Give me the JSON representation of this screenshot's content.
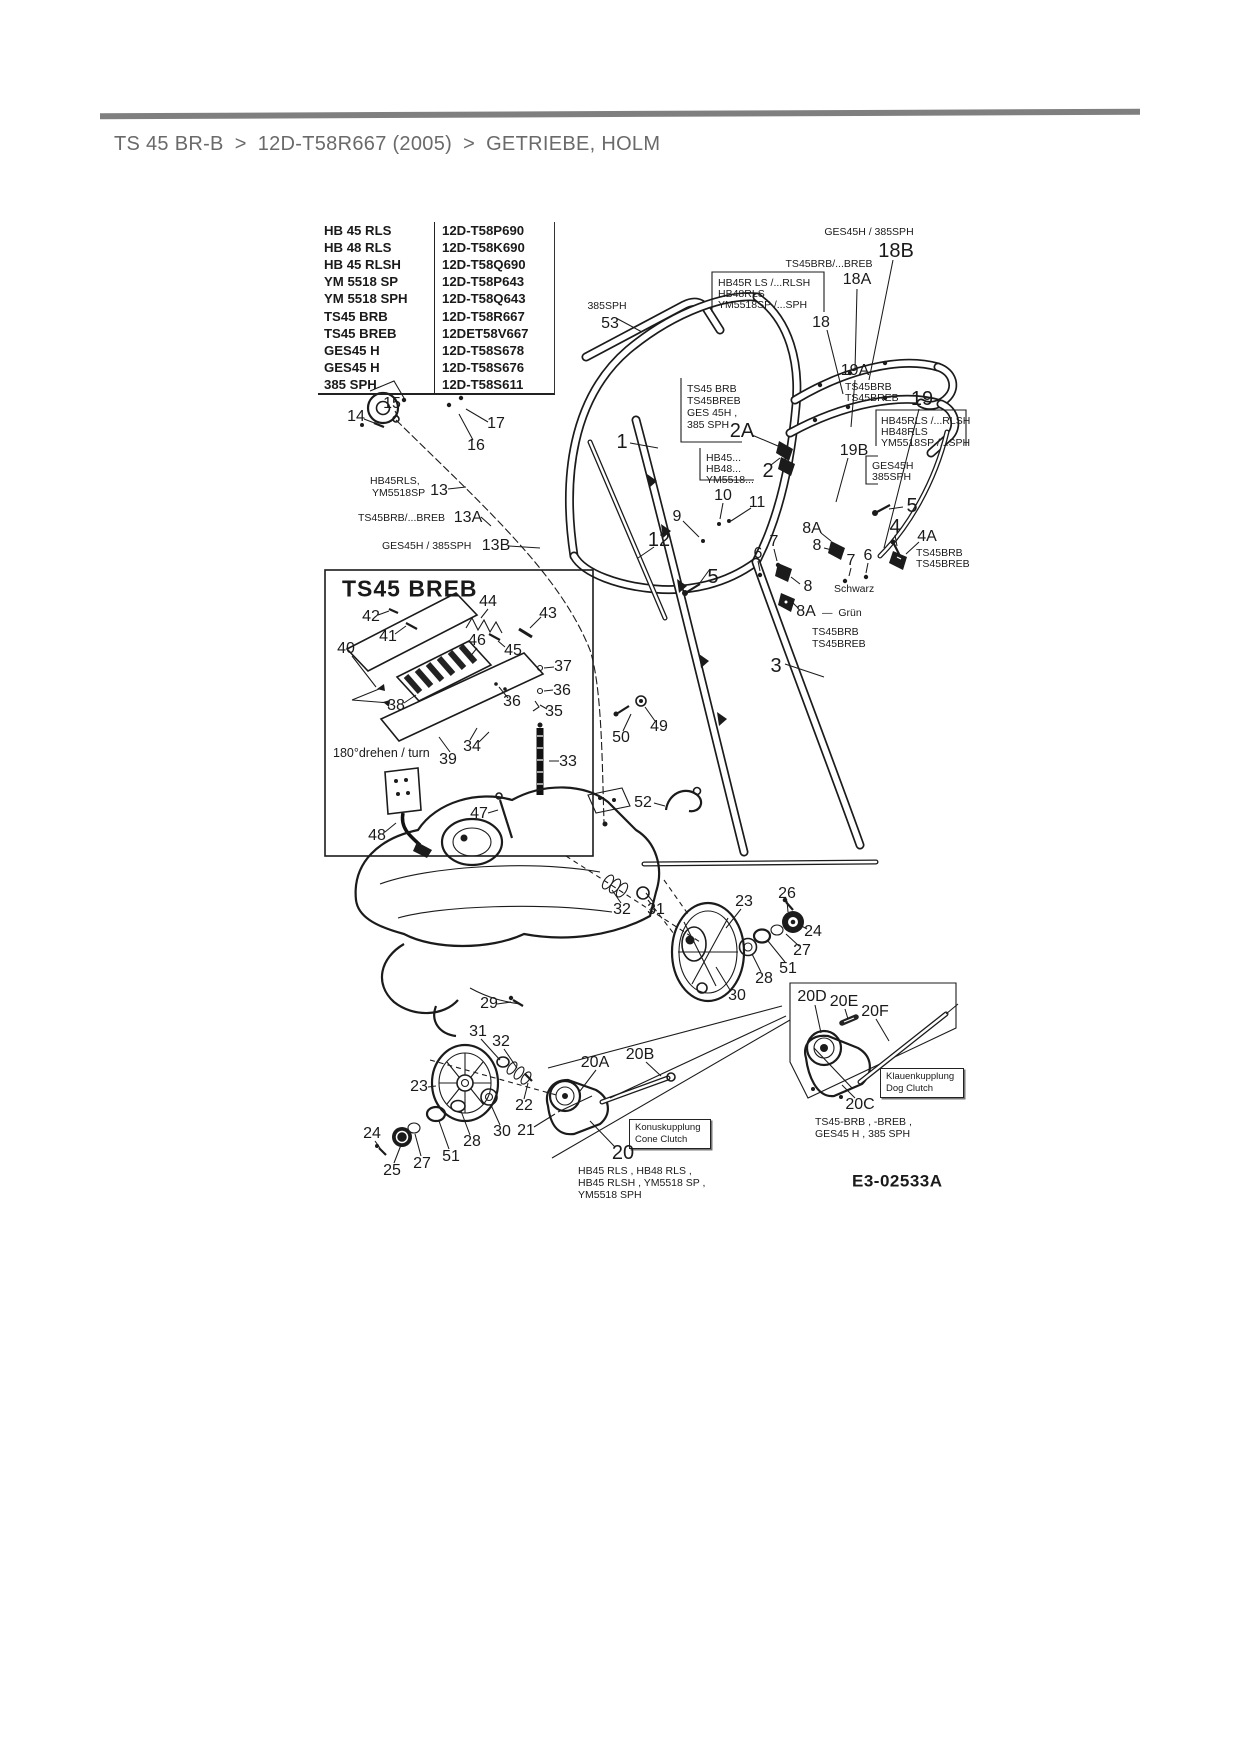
{
  "breadcrumb": {
    "separator": ">",
    "items": [
      "TS 45 BR-B",
      "12D-T58R667 (2005)",
      "GETRIEBE, HOLM"
    ]
  },
  "model_table": {
    "rows": [
      {
        "model": "HB 45 RLS",
        "artno": "12D-T58P690"
      },
      {
        "model": "HB 48 RLS",
        "artno": "12D-T58K690"
      },
      {
        "model": "HB 45 RLSH",
        "artno": "12D-T58Q690"
      },
      {
        "model": "YM 5518 SP",
        "artno": "12D-T58P643"
      },
      {
        "model": "YM 5518 SPH",
        "artno": "12D-T58Q643"
      },
      {
        "model": "TS45 BRB",
        "artno": "12D-T58R667"
      },
      {
        "model": "TS45 BREB",
        "artno": "12DET58V667"
      },
      {
        "model": "GES45 H",
        "artno": "12D-T58S678"
      },
      {
        "model": "GES45 H",
        "artno": "12D-T58S676"
      },
      {
        "model": "385 SPH",
        "artno": "12D-T58S611"
      }
    ]
  },
  "clutch": {
    "dog": [
      "Klauenkupplung",
      "Dog Clutch"
    ],
    "cone": [
      "Konuskupplung",
      "Cone Clutch"
    ]
  },
  "diagram_id": "E3-02533A",
  "ink_color": "#1b1b1b",
  "rule_color": "#7f7f7f",
  "labels": [
    {
      "t": "385SPH",
      "x": 607,
      "y": 306,
      "c": "xs"
    },
    {
      "t": "53",
      "x": 610,
      "y": 324,
      "c": "md"
    },
    {
      "t": "GES45H / 385SPH",
      "x": 869,
      "y": 232,
      "c": "xs"
    },
    {
      "t": "18B",
      "x": 896,
      "y": 251,
      "c": "lg"
    },
    {
      "t": "TS45BRB/...BREB",
      "x": 829,
      "y": 264,
      "c": "xs"
    },
    {
      "t": "18A",
      "x": 857,
      "y": 280,
      "c": "md"
    },
    {
      "t": "HB45R LS /...RLSH",
      "x": 718,
      "y": 283,
      "c": "xs",
      "a": "l"
    },
    {
      "t": "HB48RLS",
      "x": 718,
      "y": 294,
      "c": "xs",
      "a": "l"
    },
    {
      "t": "YM5518SP /...SPH",
      "x": 718,
      "y": 305,
      "c": "xs",
      "a": "l"
    },
    {
      "t": "18",
      "x": 821,
      "y": 323,
      "c": "md"
    },
    {
      "t": "19A",
      "x": 855,
      "y": 371,
      "c": "md"
    },
    {
      "t": "TS45BRB",
      "x": 845,
      "y": 387,
      "c": "xs",
      "a": "l"
    },
    {
      "t": "TS45BREB",
      "x": 845,
      "y": 398,
      "c": "xs",
      "a": "l"
    },
    {
      "t": "19",
      "x": 922,
      "y": 399,
      "c": "lg"
    },
    {
      "t": "HB45RLS /...RLSH",
      "x": 881,
      "y": 421,
      "c": "xs",
      "a": "l"
    },
    {
      "t": "HB48RLS",
      "x": 881,
      "y": 432,
      "c": "xs",
      "a": "l"
    },
    {
      "t": "YM5518SP /...SPH",
      "x": 881,
      "y": 443,
      "c": "xs",
      "a": "l"
    },
    {
      "t": "19B",
      "x": 854,
      "y": 451,
      "c": "md"
    },
    {
      "t": "GES45H",
      "x": 872,
      "y": 466,
      "c": "xs",
      "a": "l"
    },
    {
      "t": "385SPH",
      "x": 872,
      "y": 477,
      "c": "xs",
      "a": "l"
    },
    {
      "t": "TS45 BRB",
      "x": 687,
      "y": 389,
      "c": "xs",
      "a": "l"
    },
    {
      "t": "TS45BREB",
      "x": 687,
      "y": 401,
      "c": "xs",
      "a": "l"
    },
    {
      "t": "GES 45H ,",
      "x": 687,
      "y": 413,
      "c": "xs",
      "a": "l"
    },
    {
      "t": "385 SPH",
      "x": 687,
      "y": 425,
      "c": "xs",
      "a": "l"
    },
    {
      "t": "2A",
      "x": 742,
      "y": 431,
      "c": "lg"
    },
    {
      "t": "HB45...",
      "x": 706,
      "y": 458,
      "c": "xs",
      "a": "l"
    },
    {
      "t": "HB48...",
      "x": 706,
      "y": 469,
      "c": "xs",
      "a": "l"
    },
    {
      "t": "YM5518...",
      "x": 706,
      "y": 480,
      "c": "xs",
      "a": "l"
    },
    {
      "t": "2",
      "x": 768,
      "y": 471,
      "c": "lg"
    },
    {
      "t": "1",
      "x": 622,
      "y": 442,
      "c": "lg"
    },
    {
      "t": "10",
      "x": 723,
      "y": 496,
      "c": "md"
    },
    {
      "t": "11",
      "x": 757,
      "y": 503,
      "c": "md"
    },
    {
      "t": "9",
      "x": 677,
      "y": 517,
      "c": "md"
    },
    {
      "t": "12",
      "x": 659,
      "y": 540,
      "c": "lg"
    },
    {
      "t": "5",
      "x": 713,
      "y": 577,
      "c": "lg"
    },
    {
      "t": "5",
      "x": 912,
      "y": 506,
      "c": "lg"
    },
    {
      "t": "4",
      "x": 895,
      "y": 527,
      "c": "lg"
    },
    {
      "t": "4A",
      "x": 927,
      "y": 537,
      "c": "md"
    },
    {
      "t": "TS45BRB",
      "x": 916,
      "y": 553,
      "c": "xs",
      "a": "l"
    },
    {
      "t": "TS45BREB",
      "x": 916,
      "y": 564,
      "c": "xs",
      "a": "l"
    },
    {
      "t": "8A",
      "x": 812,
      "y": 529,
      "c": "md"
    },
    {
      "t": "8",
      "x": 817,
      "y": 546,
      "c": "md"
    },
    {
      "t": "7",
      "x": 774,
      "y": 542,
      "c": "md"
    },
    {
      "t": "7",
      "x": 851,
      "y": 561,
      "c": "md"
    },
    {
      "t": "6",
      "x": 758,
      "y": 554,
      "c": "md"
    },
    {
      "t": "6",
      "x": 868,
      "y": 556,
      "c": "md"
    },
    {
      "t": "8",
      "x": 808,
      "y": 587,
      "c": "md"
    },
    {
      "t": "Schwarz",
      "x": 834,
      "y": 589,
      "c": "xs",
      "a": "l"
    },
    {
      "t": "8A",
      "x": 806,
      "y": 612,
      "c": "md"
    },
    {
      "t": "—  Grün",
      "x": 822,
      "y": 613,
      "c": "xs",
      "a": "l"
    },
    {
      "t": "TS45BRB",
      "x": 812,
      "y": 632,
      "c": "xs",
      "a": "l"
    },
    {
      "t": "TS45BREB",
      "x": 812,
      "y": 644,
      "c": "xs",
      "a": "l"
    },
    {
      "t": "3",
      "x": 776,
      "y": 666,
      "c": "lg"
    },
    {
      "t": "14",
      "x": 356,
      "y": 417,
      "c": "md"
    },
    {
      "t": "15",
      "x": 392,
      "y": 404,
      "c": "md"
    },
    {
      "t": "17",
      "x": 496,
      "y": 424,
      "c": "md"
    },
    {
      "t": "16",
      "x": 476,
      "y": 446,
      "c": "md"
    },
    {
      "t": "HB45RLS,",
      "x": 370,
      "y": 481,
      "c": "xs",
      "a": "l"
    },
    {
      "t": "YM5518SP",
      "x": 372,
      "y": 493,
      "c": "xs",
      "a": "l"
    },
    {
      "t": "13",
      "x": 439,
      "y": 491,
      "c": "md"
    },
    {
      "t": "TS45BRB/...BREB",
      "x": 358,
      "y": 518,
      "c": "xs",
      "a": "l"
    },
    {
      "t": "13A",
      "x": 468,
      "y": 518,
      "c": "md"
    },
    {
      "t": "GES45H / 385SPH",
      "x": 382,
      "y": 546,
      "c": "xs",
      "a": "l"
    },
    {
      "t": "13B",
      "x": 496,
      "y": 546,
      "c": "md"
    },
    {
      "t": "49",
      "x": 659,
      "y": 727,
      "c": "md"
    },
    {
      "t": "50",
      "x": 621,
      "y": 738,
      "c": "md"
    },
    {
      "t": "52",
      "x": 643,
      "y": 803,
      "c": "md"
    },
    {
      "t": "TS45 BREB",
      "x": 342,
      "y": 589,
      "c": "title",
      "a": "l",
      "n": "inset-title"
    },
    {
      "t": "42",
      "x": 371,
      "y": 617,
      "c": "md"
    },
    {
      "t": "41",
      "x": 388,
      "y": 637,
      "c": "md"
    },
    {
      "t": "40",
      "x": 346,
      "y": 649,
      "c": "md"
    },
    {
      "t": "44",
      "x": 488,
      "y": 602,
      "c": "md"
    },
    {
      "t": "43",
      "x": 548,
      "y": 614,
      "c": "md"
    },
    {
      "t": "46",
      "x": 477,
      "y": 641,
      "c": "md"
    },
    {
      "t": "45",
      "x": 513,
      "y": 651,
      "c": "md"
    },
    {
      "t": "37",
      "x": 563,
      "y": 667,
      "c": "md"
    },
    {
      "t": "36",
      "x": 562,
      "y": 691,
      "c": "md"
    },
    {
      "t": "35",
      "x": 554,
      "y": 712,
      "c": "md"
    },
    {
      "t": "36",
      "x": 512,
      "y": 702,
      "c": "md"
    },
    {
      "t": "38",
      "x": 396,
      "y": 706,
      "c": "md"
    },
    {
      "t": "34",
      "x": 472,
      "y": 747,
      "c": "md"
    },
    {
      "t": "39",
      "x": 448,
      "y": 760,
      "c": "md"
    },
    {
      "t": "33",
      "x": 568,
      "y": 762,
      "c": "md"
    },
    {
      "t": "180°drehen / turn",
      "x": 333,
      "y": 753,
      "c": "sm",
      "a": "l",
      "n": "rotate-note"
    },
    {
      "t": "47",
      "x": 479,
      "y": 814,
      "c": "md"
    },
    {
      "t": "48",
      "x": 377,
      "y": 836,
      "c": "md"
    },
    {
      "t": "23",
      "x": 744,
      "y": 902,
      "c": "md"
    },
    {
      "t": "26",
      "x": 787,
      "y": 894,
      "c": "md"
    },
    {
      "t": "24",
      "x": 813,
      "y": 932,
      "c": "md"
    },
    {
      "t": "27",
      "x": 802,
      "y": 951,
      "c": "md"
    },
    {
      "t": "51",
      "x": 788,
      "y": 969,
      "c": "md"
    },
    {
      "t": "28",
      "x": 764,
      "y": 979,
      "c": "md"
    },
    {
      "t": "30",
      "x": 737,
      "y": 996,
      "c": "md"
    },
    {
      "t": "32",
      "x": 622,
      "y": 910,
      "c": "md"
    },
    {
      "t": "31",
      "x": 656,
      "y": 910,
      "c": "md"
    },
    {
      "t": "29",
      "x": 489,
      "y": 1004,
      "c": "md"
    },
    {
      "t": "31",
      "x": 478,
      "y": 1032,
      "c": "md"
    },
    {
      "t": "32",
      "x": 501,
      "y": 1042,
      "c": "md"
    },
    {
      "t": "23",
      "x": 419,
      "y": 1087,
      "c": "md"
    },
    {
      "t": "22",
      "x": 524,
      "y": 1106,
      "c": "md"
    },
    {
      "t": "21",
      "x": 526,
      "y": 1131,
      "c": "md"
    },
    {
      "t": "30",
      "x": 502,
      "y": 1132,
      "c": "md"
    },
    {
      "t": "28",
      "x": 472,
      "y": 1142,
      "c": "md"
    },
    {
      "t": "51",
      "x": 451,
      "y": 1157,
      "c": "md"
    },
    {
      "t": "27",
      "x": 422,
      "y": 1164,
      "c": "md"
    },
    {
      "t": "25",
      "x": 392,
      "y": 1171,
      "c": "md"
    },
    {
      "t": "24",
      "x": 372,
      "y": 1134,
      "c": "md"
    },
    {
      "t": "20A",
      "x": 595,
      "y": 1063,
      "c": "md"
    },
    {
      "t": "20B",
      "x": 640,
      "y": 1055,
      "c": "md"
    },
    {
      "t": "20",
      "x": 623,
      "y": 1153,
      "c": "lg"
    },
    {
      "t": "20D",
      "x": 812,
      "y": 997,
      "c": "md"
    },
    {
      "t": "20E",
      "x": 844,
      "y": 1002,
      "c": "md"
    },
    {
      "t": "20F",
      "x": 875,
      "y": 1012,
      "c": "md"
    },
    {
      "t": "20C",
      "x": 860,
      "y": 1105,
      "c": "md"
    },
    {
      "t": "HB45 RLS , HB48 RLS ,",
      "x": 578,
      "y": 1171,
      "c": "xs",
      "a": "l"
    },
    {
      "t": "HB45 RLSH , YM5518 SP ,",
      "x": 578,
      "y": 1183,
      "c": "xs",
      "a": "l"
    },
    {
      "t": "YM5518 SPH",
      "x": 578,
      "y": 1195,
      "c": "xs",
      "a": "l"
    },
    {
      "t": "TS45-BRB , -BREB ,",
      "x": 815,
      "y": 1122,
      "c": "xs",
      "a": "l"
    },
    {
      "t": "GES45 H , 385 SPH",
      "x": 815,
      "y": 1134,
      "c": "xs",
      "a": "l"
    },
    {
      "t": "E3-02533A",
      "x": 852,
      "y": 1181,
      "c": "id",
      "a": "l",
      "n": "diagram-id"
    }
  ]
}
